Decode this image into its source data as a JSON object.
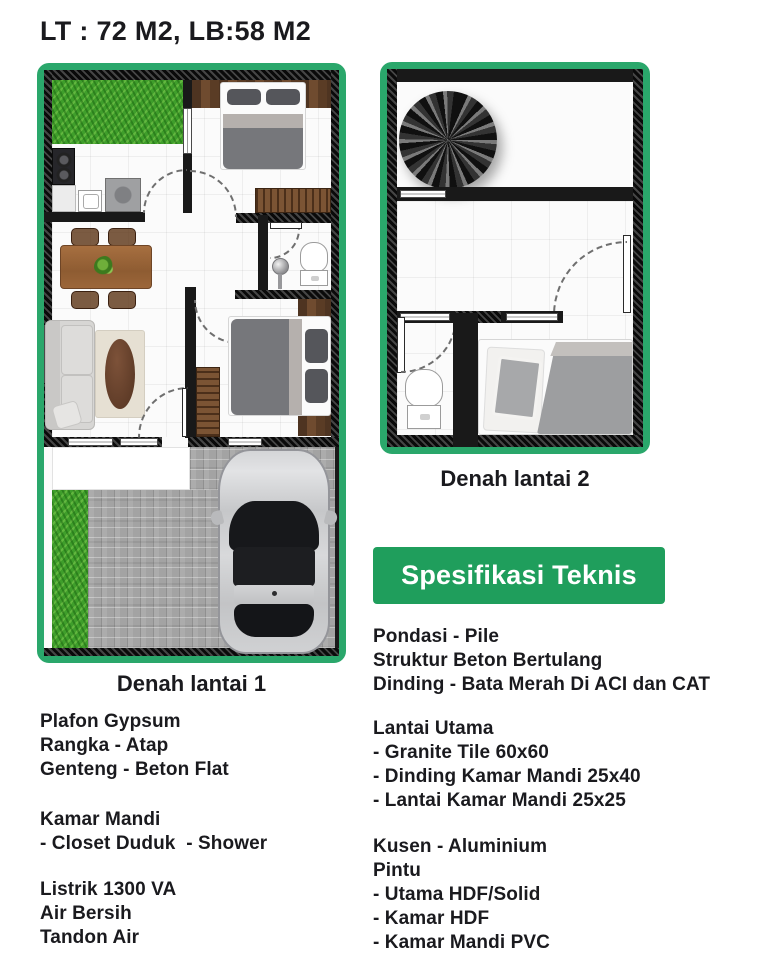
{
  "title": "LT : 72 M2, LB:58 M2",
  "plans": {
    "plan1": {
      "label": "Denah lantai 1"
    },
    "plan2": {
      "label": "Denah lantai 2"
    }
  },
  "banner": {
    "label": "Spesifikasi Teknis"
  },
  "specs": {
    "left": [
      {
        "lines": [
          "Plafon Gypsum",
          "Rangka - Atap",
          "Genteng - Beton Flat"
        ]
      },
      {
        "lines": [
          "Kamar Mandi",
          "- Closet Duduk  - Shower"
        ]
      },
      {
        "lines": [
          "Listrik 1300 VA",
          "Air Bersih",
          "Tandon Air"
        ]
      }
    ],
    "right": [
      {
        "lines": [
          "Pondasi - Pile",
          "Struktur Beton Bertulang",
          "Dinding - Bata Merah Di ACI dan CAT"
        ]
      },
      {
        "lines": [
          "Lantai Utama",
          "- Granite Tile 60x60",
          "- Dinding Kamar Mandi 25x40",
          "- Lantai Kamar Mandi 25x25"
        ]
      },
      {
        "lines": [
          "Kusen - Aluminium",
          "Pintu",
          "- Utama HDF/Solid",
          "- Kamar HDF",
          "- Kamar Mandi PVC"
        ]
      }
    ]
  },
  "colors": {
    "frame_green": "#2aa76b",
    "banner_green": "#1f9e5c",
    "text": "#1a1a1e",
    "grass": "#3f9e2b",
    "paver": "#a3a3a3"
  }
}
